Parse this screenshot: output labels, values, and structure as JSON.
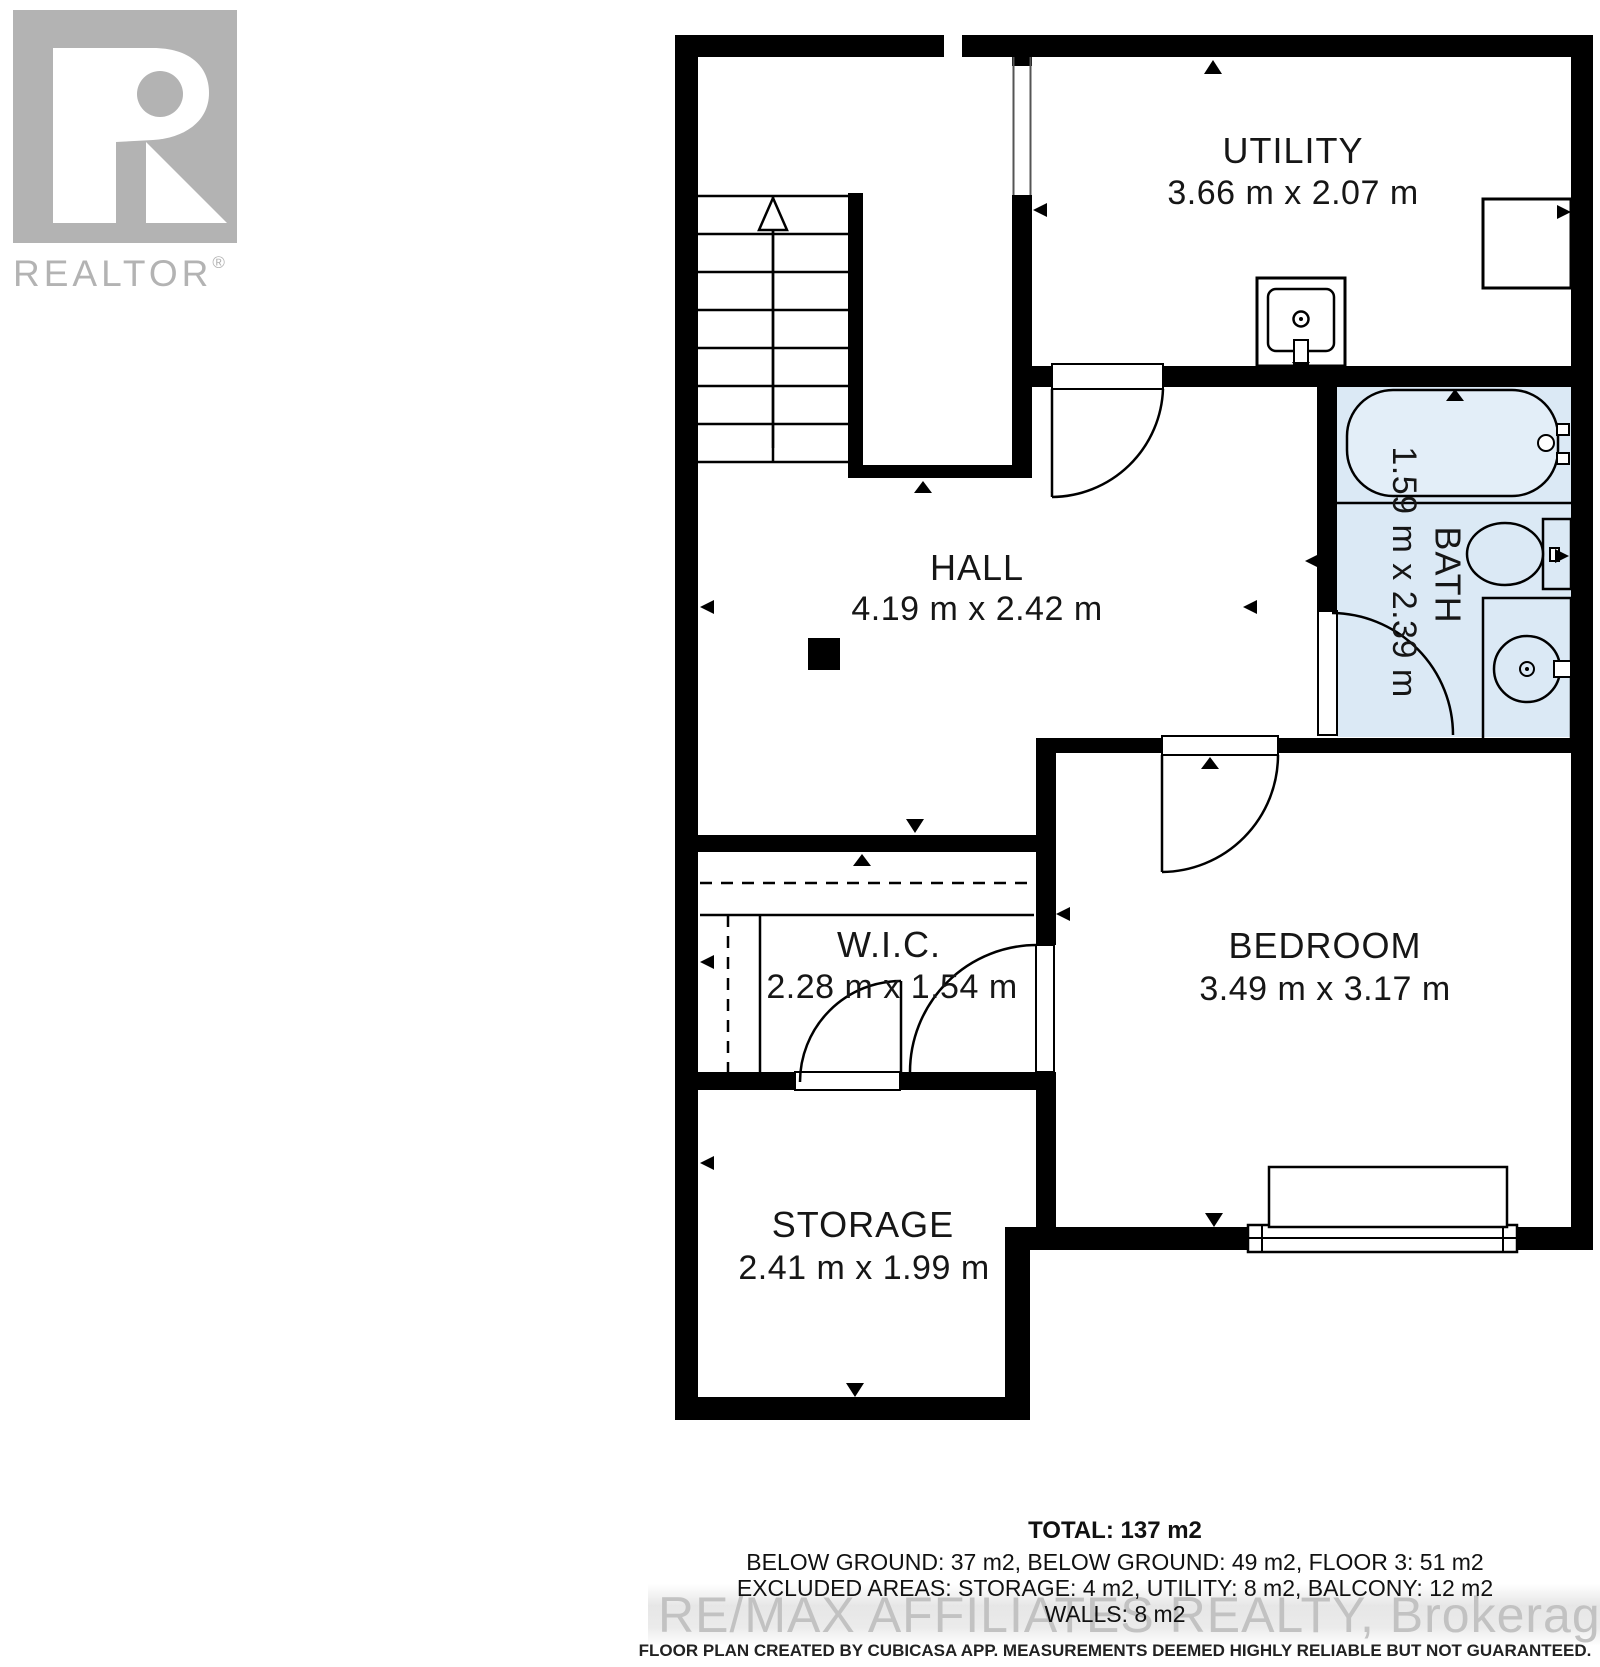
{
  "branding": {
    "logo_letter": "R",
    "logo_text": "REALTOR",
    "registered": "®"
  },
  "rooms": [
    {
      "name": "UTILITY",
      "dims": "3.66 m x 2.07 m"
    },
    {
      "name": "HALL",
      "dims": "4.19 m x 2.42 m"
    },
    {
      "name": "BATH",
      "dims": "1.59 m x 2.39 m"
    },
    {
      "name": "W.I.C.",
      "dims": "2.28 m x 1.54 m"
    },
    {
      "name": "BEDROOM",
      "dims": "3.49 m x 3.17 m"
    },
    {
      "name": "STORAGE",
      "dims": "2.41 m x 1.99 m"
    }
  ],
  "summary": {
    "total": "TOTAL: 137 m2",
    "areas": "BELOW GROUND: 37 m2, BELOW GROUND: 49 m2, FLOOR 3: 51 m2",
    "excluded": "EXCLUDED AREAS: STORAGE: 4 m2, UTILITY: 8 m2, BALCONY: 12 m2",
    "walls": "WALLS: 8 m2"
  },
  "watermark": "RE/MAX AFFILIATES REALTY, Brokerage",
  "disclaimer": "FLOOR PLAN CREATED BY CUBICASA APP. MEASUREMENTS DEEMED HIGHLY RELIABLE BUT NOT GUARANTEED.",
  "fixtures": [
    "staircase",
    "up-arrow",
    "utility-sink",
    "appliance",
    "bathtub",
    "toilet",
    "vanity-sink",
    "closet-rail",
    "wardrobe",
    "dresser",
    "window",
    "column"
  ],
  "colors": {
    "wall": "#000000",
    "bath_fill": "#dbe9f5",
    "watermark": "#c2c2c2",
    "logo": "#b3b3b3",
    "text": "#161616"
  }
}
